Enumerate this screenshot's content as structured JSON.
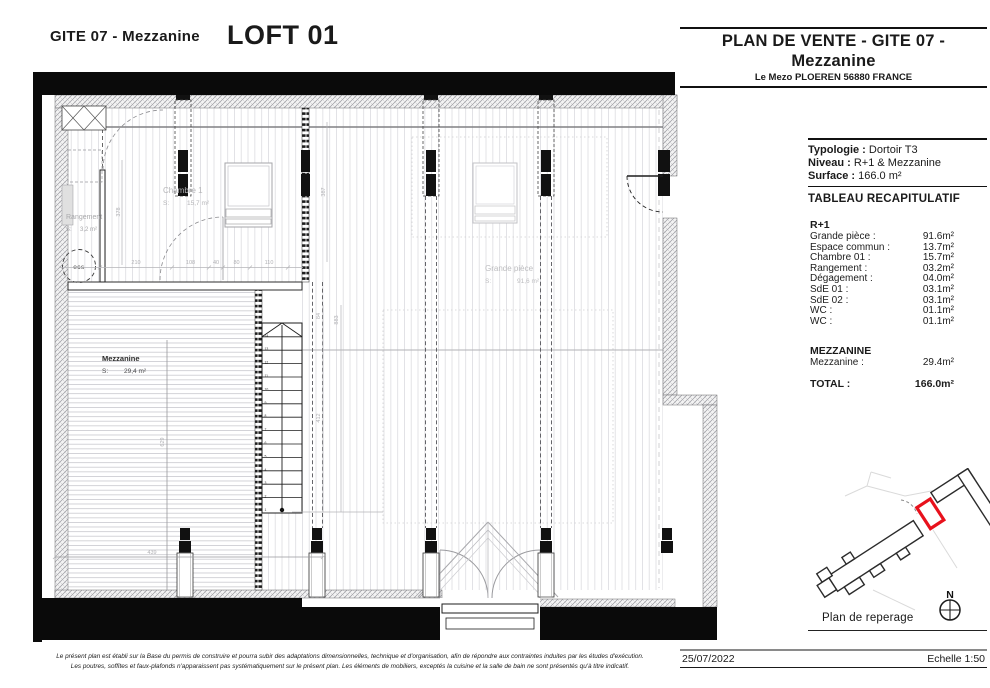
{
  "header": {
    "project": "GITE 07 - Mezzanine",
    "unit": "LOFT 01"
  },
  "panel": {
    "title_line1": "PLAN DE VENTE - GITE 07 -",
    "title_line2": "Mezzanine",
    "address": "Le Mezo PLOEREN 56880 FRANCE",
    "typologie_label": "Typologie :",
    "typologie_value": "Dortoir T3",
    "niveau_label": "Niveau :",
    "niveau_value": "R+1 & Mezzanine",
    "surface_label": "Surface :",
    "surface_value": "166.0 m²",
    "table_title": "TABLEAU RECAPITULATIF",
    "r1": {
      "title": "R+1",
      "rows": [
        {
          "label": "Grande pièce :",
          "value": "91.6m²"
        },
        {
          "label": "Espace commun :",
          "value": "13.7m²"
        },
        {
          "label": "Chambre 01 :",
          "value": "15.7m²"
        },
        {
          "label": "Rangement :",
          "value": "03.2m²"
        },
        {
          "label": "Dégagement :",
          "value": "04.0m²"
        },
        {
          "label": "SdE 01 :",
          "value": "03.1m²"
        },
        {
          "label": "SdE 02 :",
          "value": "03.1m²"
        },
        {
          "label": "WC :",
          "value": "01.1m²"
        },
        {
          "label": "WC :",
          "value": "01.1m²"
        }
      ]
    },
    "mezzanine": {
      "title": "MEZZANINE",
      "rows": [
        {
          "label": "Mezzanine :",
          "value": "29.4m²"
        }
      ]
    },
    "total": {
      "label": "TOTAL :",
      "value": "166.0m²"
    },
    "reperage_label": "Plan de reperage",
    "north_label": "N",
    "date": "25/07/2022",
    "scale": "Echelle 1:50",
    "accent_red": "#e8111c"
  },
  "plan": {
    "rooms": {
      "chambre1": {
        "name": "Chambre 1",
        "s": "S:",
        "area": "15,7 m²"
      },
      "rangement": {
        "name": "Rangement",
        "s": "S:",
        "area": "3,2 m²"
      },
      "grande_piece": {
        "name": "Grande pièce",
        "s": "S:",
        "area": "91,6 m²"
      },
      "mezzanine": {
        "name": "Mezzanine",
        "s": "S:",
        "area": "29,4 m²"
      }
    },
    "ecs_label": "ecs",
    "stairs": {
      "steps": 14
    },
    "dims": {
      "d1": "378",
      "d2": "210",
      "d3": "108",
      "d4": "40",
      "d5": "80",
      "d6": "110",
      "d7": "387",
      "d8": "84",
      "d9": "883",
      "d10": "412",
      "d11": "629",
      "d12": "439"
    }
  },
  "footer": {
    "disclaimer_line1": "Le présent plan est établi sur la Base du permis de construire et pourra subir des adaptations dimensionnelles, technique et d'organisation, afin de répondre aux contraintes induites par les études d'exécution.",
    "disclaimer_line2": "Les poutres, soffites et faux-plafonds n'apparaissent pas systématiquement sur le présent plan. Les éléments de mobiliers, exceptés la cuisine et la salle de bain ne sont présentés qu'à titre indicatif."
  }
}
